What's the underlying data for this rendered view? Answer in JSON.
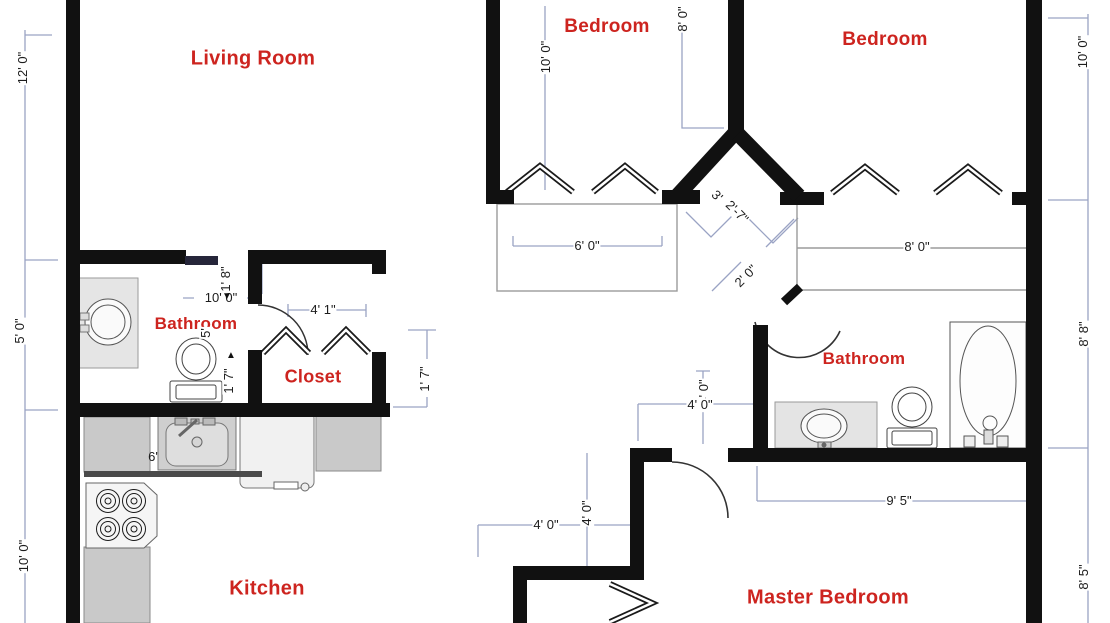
{
  "title": "Apartment Floor Plan",
  "palette": {
    "background": "#ffffff",
    "wall": "#111111",
    "room_label": "#cd241f",
    "dim_text": "#1c1c1c",
    "dim_line": "#9aa3c4",
    "outline_gray": "#9b9b9b",
    "counter": "#c9c9c9",
    "vanity": "#e5e5e5",
    "fixture_fill": "#f5f5f5"
  },
  "rooms": {
    "living_room": {
      "label": "Living Room"
    },
    "bedroom_left": {
      "label": "Bedroom"
    },
    "bedroom_right": {
      "label": "Bedroom"
    },
    "bathroom_left": {
      "label": "Bathroom"
    },
    "closet": {
      "label": "Closet"
    },
    "kitchen": {
      "label": "Kitchen"
    },
    "bathroom_right": {
      "label": "Bathroom"
    },
    "master_bedroom": {
      "label": "Master Bedroom"
    }
  },
  "dimensions": {
    "left_top": "12' 0\"",
    "left_mid": "5' 0\"",
    "left_bottom": "10' 0\"",
    "right_top": "10' 0\"",
    "right_mid": "8' 8\"",
    "right_bottom": "8' 5\"",
    "bedroom_left_height": "10' 0\"",
    "bedroom_left_depth": "8' 0\"",
    "closet_bedroom_left": "6' 0\"",
    "closet_bedroom_right": "8' 0\"",
    "hall_angled_a": "3'",
    "hall_angled_b": "2'-7\"",
    "bathroom_right_door": "2' 0\"",
    "bathroom_left_door": "1' 8\"",
    "bathroom_left_width": "10' 0\"",
    "bathroom_left_partial": "5'",
    "bathroom_left_clear": "1' 7\"",
    "closet_door": "4' 1\"",
    "closet_side_clear": "1' 7\"",
    "bathroom_right_width": "4' 0\"",
    "bathroom_right_depth": "4' 0\"",
    "master_width": "9' 5\"",
    "hall_width": "4' 0\"",
    "hall_depth": "4' 0\"",
    "kitchen_counter": "6'"
  },
  "markers": {
    "arrow_down": "▼",
    "arrow_up": "▲"
  },
  "fixture_icons": [
    "round-sink-icon",
    "toilet-icon",
    "oval-sink-icon",
    "bathtub-icon",
    "kitchen-sink-icon",
    "stove-icon",
    "dishwasher-icon",
    "counter",
    "bifold-door-icon",
    "door-swing-icon"
  ]
}
